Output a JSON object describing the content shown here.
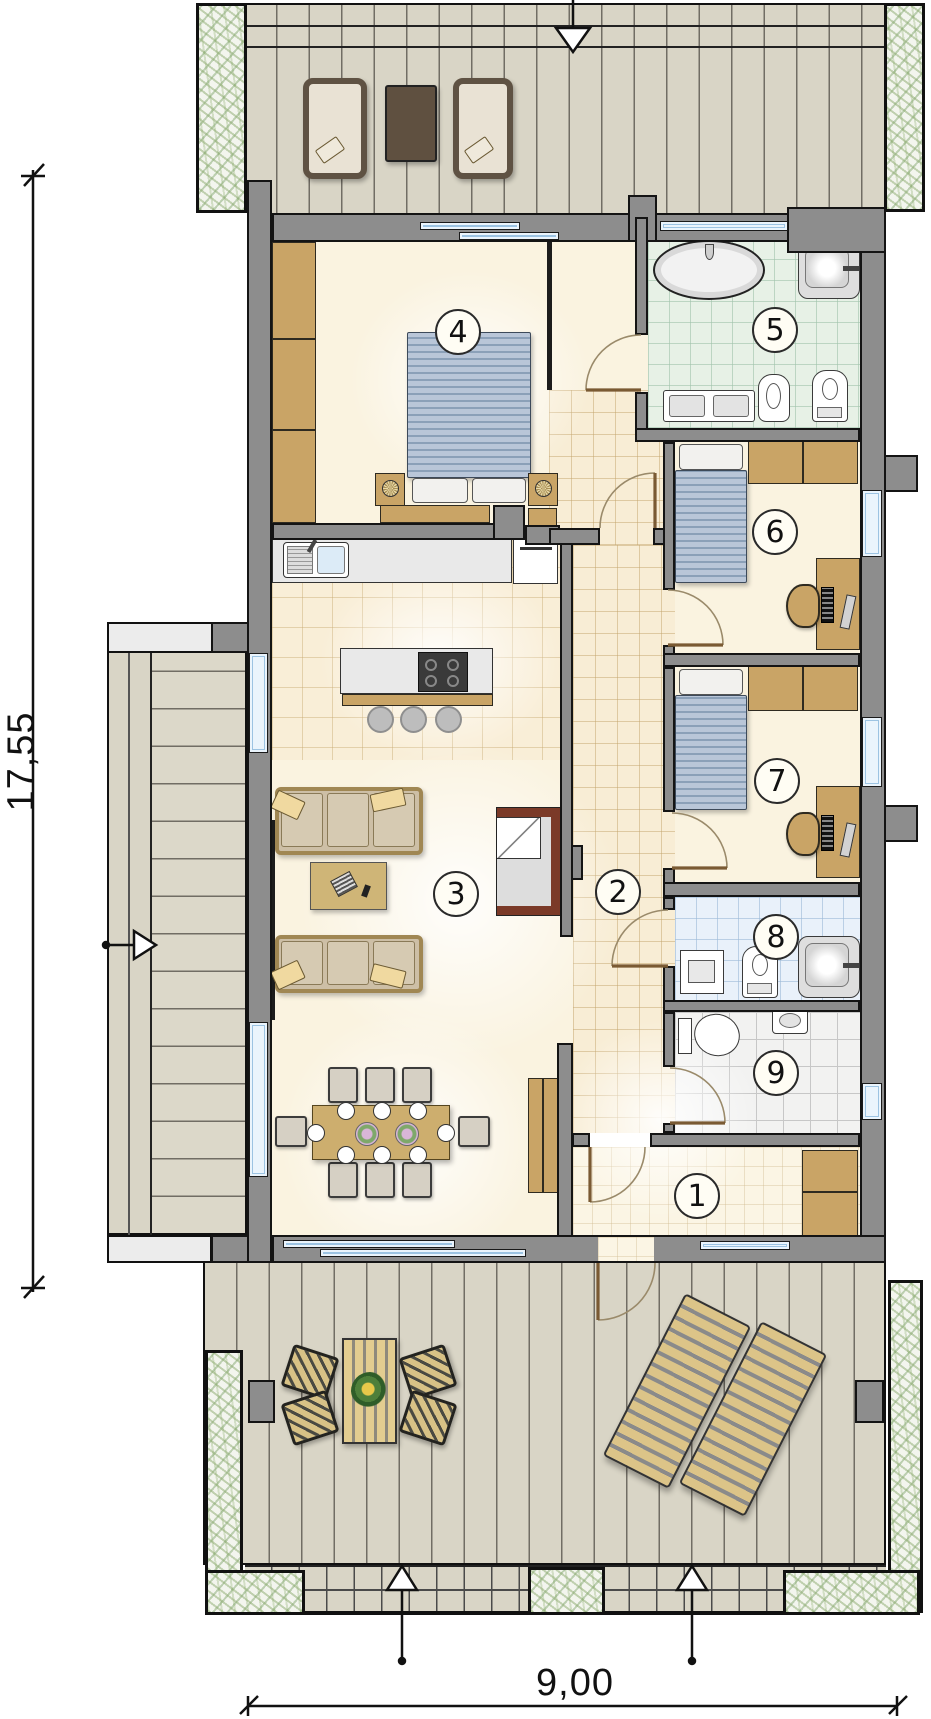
{
  "title": "single-storey house floor plan",
  "rooms": [
    {
      "id": "1",
      "label": "1"
    },
    {
      "id": "2",
      "label": "2"
    },
    {
      "id": "3",
      "label": "3"
    },
    {
      "id": "4",
      "label": "4"
    },
    {
      "id": "5",
      "label": "5"
    },
    {
      "id": "6",
      "label": "6"
    },
    {
      "id": "7",
      "label": "7"
    },
    {
      "id": "8",
      "label": "8"
    },
    {
      "id": "9",
      "label": "9"
    }
  ],
  "dimensions": {
    "vertical_label": "17,55",
    "horizontal_label": "9,00"
  },
  "colors": {
    "wall_gray": "#8d8d8d",
    "outline_black": "#141414",
    "floor_cream": "#faf3e0",
    "hall_tile": "#f8edd5",
    "bath_tile_green": "#e7f1e6",
    "bath_tile_blue": "#e9f1fa",
    "deck_wood": "#d9d5c6",
    "furniture_tan": "#c9a466",
    "bed_blue": "#aebfd4",
    "fireplace_red": "#7b3a28",
    "planting_green": "#9ab57e",
    "window_blue": "#eaf4fc"
  }
}
